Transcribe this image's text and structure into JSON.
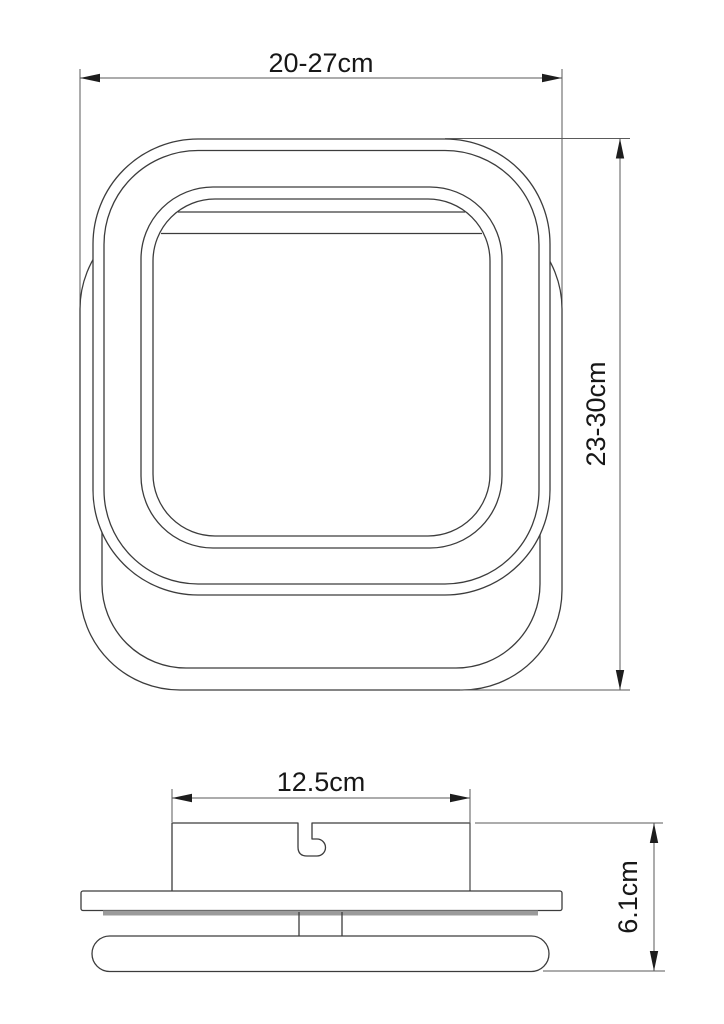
{
  "diagram": {
    "kind": "technical-drawing",
    "subject": "square ceiling light fixture, front view and side view with dimensions",
    "front_view": {
      "width_label": "20-27cm",
      "height_label": "23-30cm"
    },
    "side_view": {
      "bracket_width_label": "12.5cm",
      "height_label": "6.1cm"
    },
    "colors": {
      "line": "#3c3c3c",
      "dimension_line": "#5a5a5a",
      "arrow": "#1d1d1d",
      "text": "#171717",
      "plate_lip_gray": "#9b9b9b",
      "background": "#ffffff"
    }
  }
}
